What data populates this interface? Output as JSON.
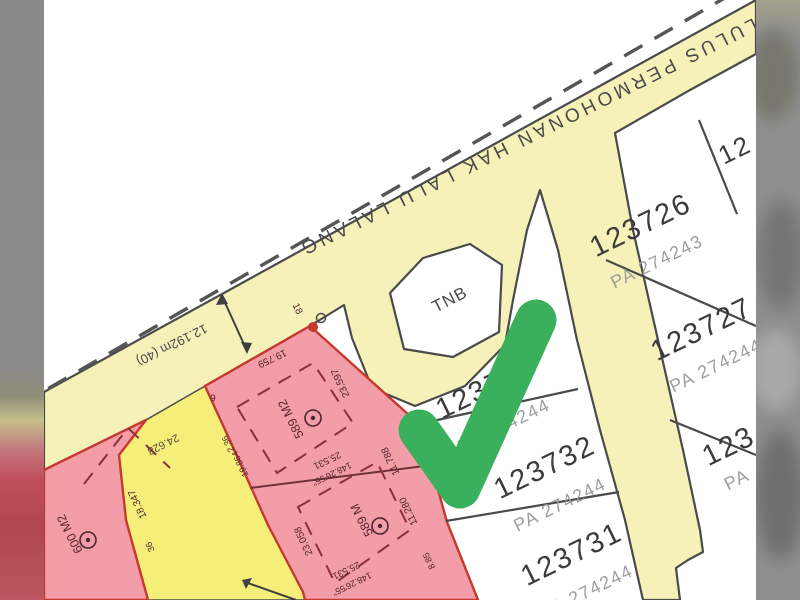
{
  "map": {
    "road_label": "LULUS PERMOHONAN HAK LALU LALANG",
    "road_width_label": "12.192m (40)",
    "wedge_label": "24.628",
    "tnb_label": "TNB",
    "lots": [
      {
        "id": "123726",
        "pa": "PA 274243"
      },
      {
        "id": "123727",
        "pa": "PA 274244"
      },
      {
        "id": "123733",
        "pa": "PA 274244"
      },
      {
        "id": "123732",
        "pa": "PA 274244"
      },
      {
        "id": "123731",
        "pa": "PA 274244"
      },
      {
        "id": "12",
        "pa": ""
      },
      {
        "id": "123",
        "pa": "PA"
      }
    ],
    "pink_lots": [
      {
        "area": "600 M2"
      },
      {
        "area": "589 M2"
      },
      {
        "area": "589 M"
      }
    ],
    "measurements": [
      {
        "text": "19.759",
        "x": 272,
        "y": 358,
        "rot": 155,
        "size": 10
      },
      {
        "text": "23.597",
        "x": 341,
        "y": 383,
        "rot": 245,
        "size": 10
      },
      {
        "text": "2.36",
        "x": 228,
        "y": 444,
        "rot": 245,
        "size": 9
      },
      {
        "text": "19.864",
        "x": 240,
        "y": 464,
        "rot": 245,
        "size": 9
      },
      {
        "text": "25.531",
        "x": 327,
        "y": 460,
        "rot": 154,
        "size": 9.5
      },
      {
        "text": "148.26'55\"",
        "x": 332,
        "y": 474,
        "rot": 154,
        "size": 9
      },
      {
        "text": "11.788",
        "x": 391,
        "y": 461,
        "rot": 245,
        "size": 10
      },
      {
        "text": "11.280",
        "x": 409,
        "y": 511,
        "rot": 245,
        "size": 10
      },
      {
        "text": "8.85",
        "x": 429,
        "y": 561,
        "rot": 245,
        "size": 9
      },
      {
        "text": "23.058",
        "x": 304,
        "y": 541,
        "rot": 245,
        "size": 10
      },
      {
        "text": "18.347",
        "x": 138,
        "y": 504,
        "rot": 245,
        "size": 10
      },
      {
        "text": "36",
        "x": 150,
        "y": 547,
        "rot": 245,
        "size": 9
      },
      {
        "text": "25.531",
        "x": 346,
        "y": 570,
        "rot": 154,
        "size": 9.5
      },
      {
        "text": "148.26'55\"",
        "x": 352,
        "y": 584,
        "rot": 154,
        "size": 9
      },
      {
        "text": "6",
        "x": 213,
        "y": 397,
        "rot": 180,
        "size": 10
      },
      {
        "text": "18",
        "x": 297,
        "y": 309,
        "rot": 65,
        "size": 10
      }
    ],
    "annotation": {
      "icon": "green-checkmark-icon",
      "color": "#3bb05c"
    },
    "colors": {
      "road_yellow": "#f5f1b8",
      "wedge_yellow": "#f5ef7a",
      "pink_lot": "#f29da8",
      "lot_boundary_red": "#c5392e",
      "line_dark": "#4a4a4a",
      "lot_number_text": "#3b3b3b",
      "pa_text": "#9e9e9e",
      "check_green": "#3bb05c",
      "edge_blur_gray": "#8a8a8a"
    }
  }
}
